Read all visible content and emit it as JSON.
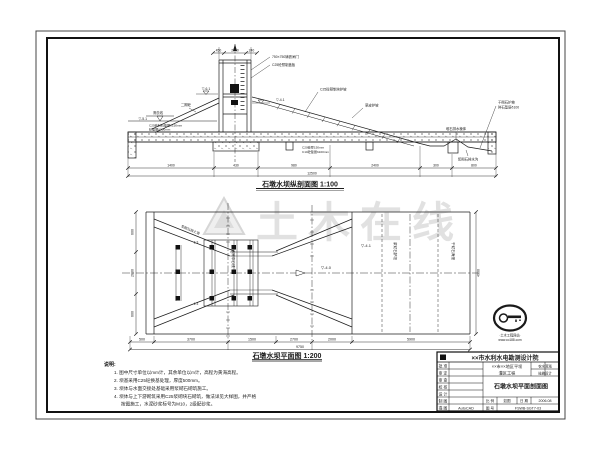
{
  "sheet": {
    "background": "#ffffff",
    "line_color": "#1c1c1c",
    "watermark_color": "#c9c9c9"
  },
  "section_view": {
    "caption": "石墩水坝纵剖面图 1:100",
    "top_dims": [
      "450",
      "2850",
      "240"
    ],
    "labels": {
      "gate_size": "750×750铸铁闸门",
      "gate_cover": "C25砼预制盖板",
      "stage2_concrete": "二期砼",
      "dredge_line": "清淤线",
      "elev_left": "▽-5.1",
      "elev_crest": "▽-6.1",
      "elev_right": "▽-4.1",
      "slope_precast": "C25砼预制块护坡",
      "slope_grass": "草皮护坡",
      "drain_prism": "堆石排水棱体",
      "drain_ditch": "浆砌石排水沟",
      "right_far_1": "干砌石护坡",
      "right_far_2": "碎石垫层δ100",
      "bed_layer_1": "C25砼料石垫层δ150mm",
      "bed_layer_2": "砂垫层δ200mm",
      "base_layer_1": "C20砼厚150mm",
      "base_layer_2": "C10砼垫层δ100mm"
    },
    "bottom_dims": [
      "1400",
      "430",
      "980",
      "2400",
      "300",
      "800"
    ],
    "total_dim": "12500"
  },
  "plan_view": {
    "caption": "石墩水坝平面图 1:200",
    "labels": {
      "axis_gate": "进水闸中心线",
      "retaining_wall": "浆砌石挡土墙",
      "apron": "浆砌石护坦",
      "riprap": "干砌石海漫",
      "elev_center": "▽-4.0",
      "elev_apron": "▽-4.1",
      "slope_top": "1:3",
      "slope_bottom": "1:3"
    },
    "left_dims": [
      "600",
      "2600",
      "600"
    ],
    "right_dim": "4900",
    "bottom_dims": [
      "500",
      "3700",
      "1500",
      "2700",
      "2000",
      "5900"
    ],
    "total_dim": "9750"
  },
  "notes": {
    "title": "说明:",
    "items": [
      "1. 图中尺寸单位以mm计，其余单位以m计，高程为黄海高程。",
      "2. 坝基采用C25砼换基处理，厚度500mm。",
      "3. 坝体与水面交接处基础采用浆砌石砌筑施工。",
      "4. 坝体与上下游砌筑采用C25浆砌块石砌筑，做法详见大样图，并严格",
      "按图施工，水泥砂浆标号为M10，2级配砂浆。"
    ]
  },
  "title_block": {
    "institute": "××市水利水电勘测设计院",
    "rows": [
      "批 准",
      "审 定",
      "审 查",
      "校 核",
      "设 计",
      "制 图",
      "描 图"
    ],
    "autocad": "AutoCAD",
    "project_line1": "××市××地区平坝",
    "project_line2": "灌区工程",
    "stage_top": "农水灌溉",
    "stage_bottom": "技施设计",
    "drawing_title": "石墩水坝平面剖面图",
    "scale_label": "比 例",
    "scale_value": "如图",
    "date_label": "日 期",
    "date_value": "2006.08",
    "no_label": "图 号",
    "no_value": "FSWB-SGT7-03"
  },
  "watermark": {
    "big_text": "土木在线",
    "stamp_line1": "·土木工程网站·",
    "stamp_line2": "www.co188.com"
  }
}
